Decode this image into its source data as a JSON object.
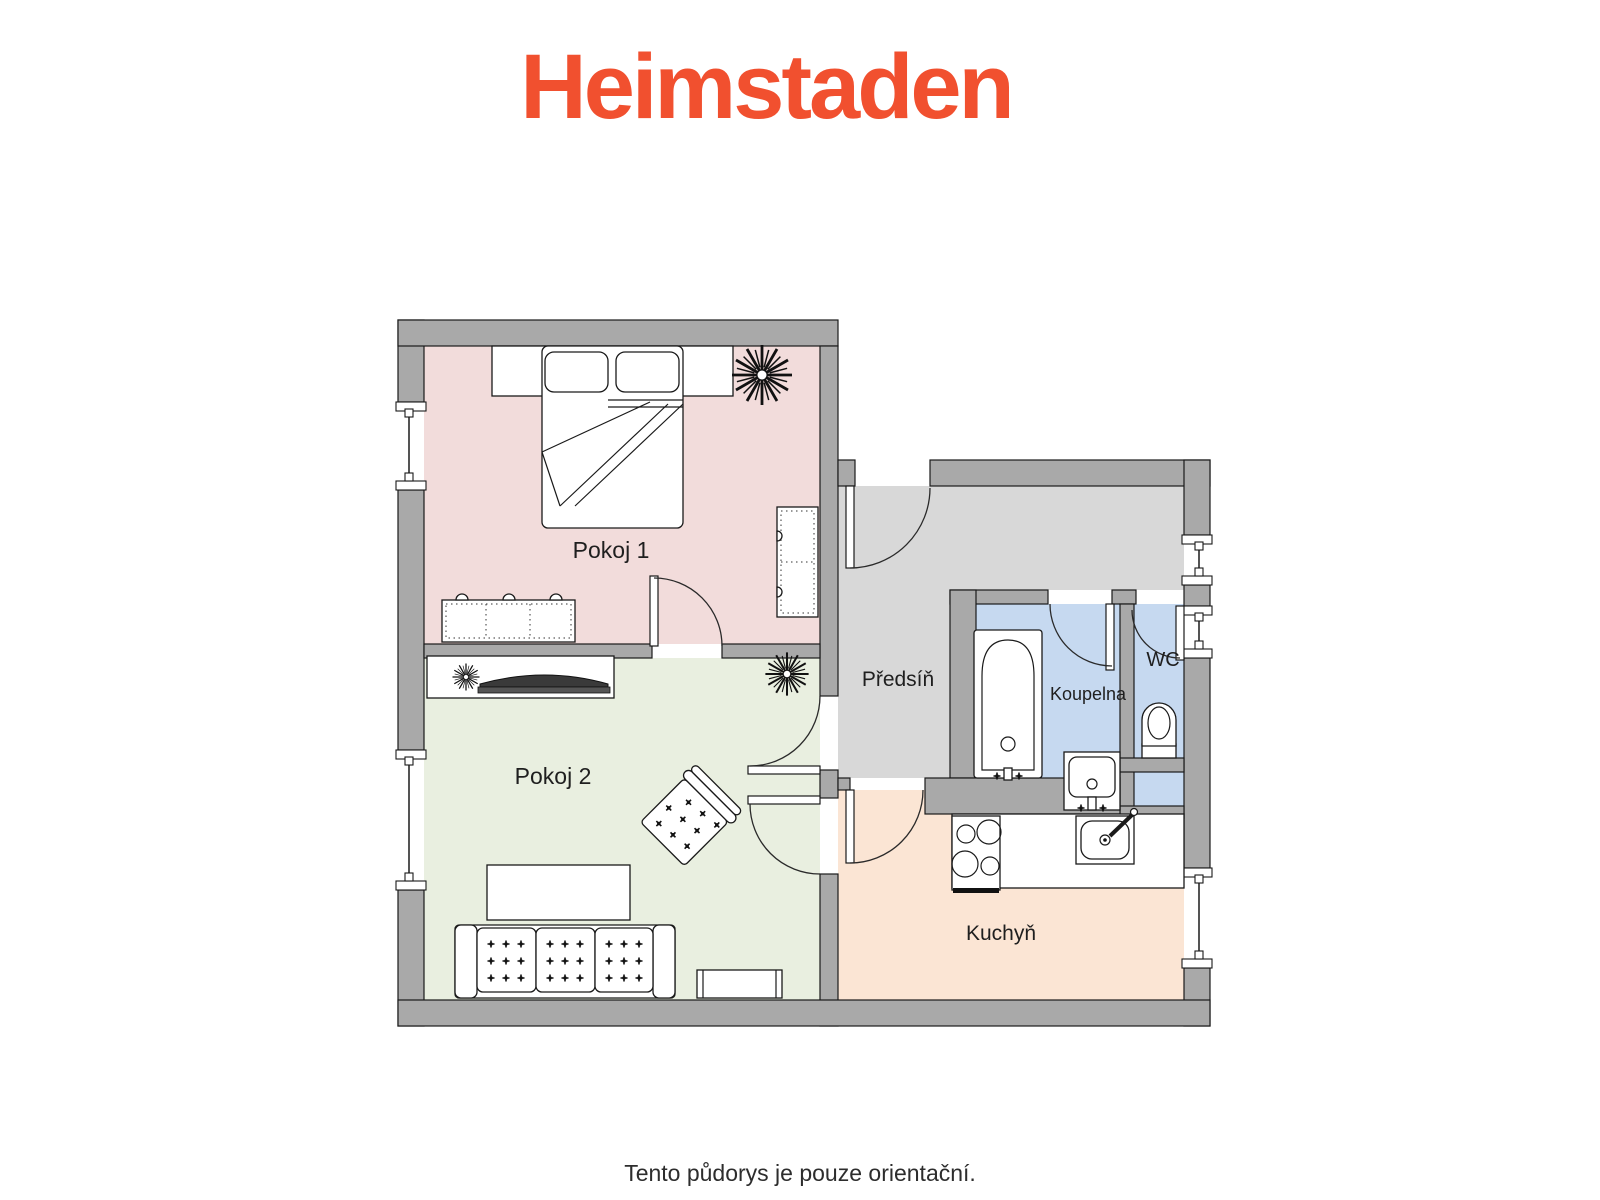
{
  "logo": {
    "text": "Heimstaden",
    "color": "#f1502f"
  },
  "caption": {
    "text": "Tento půdorys je pouze orientační."
  },
  "colors": {
    "wall": "#a9a9a9",
    "wall_outline": "#1a1a1a",
    "floor_pokoj1": "#f2dcdb",
    "floor_pokoj2": "#e9efe0",
    "floor_predsin": "#d8d8d8",
    "floor_koupelna": "#c6d9f0",
    "floor_wc": "#c6d9f0",
    "floor_kuchyn": "#fbe5d4"
  },
  "rooms": [
    {
      "label": "Pokoj 1",
      "color": "#f2dcdb"
    },
    {
      "label": "Pokoj 2",
      "color": "#e9efe0"
    },
    {
      "label": "Předsíň",
      "color": "#d8d8d8"
    },
    {
      "label": "Koupelna",
      "color": "#c6d9f0"
    },
    {
      "label": "WC",
      "color": "#c6d9f0"
    },
    {
      "label": "Kuchyň",
      "color": "#fbe5d4"
    }
  ]
}
